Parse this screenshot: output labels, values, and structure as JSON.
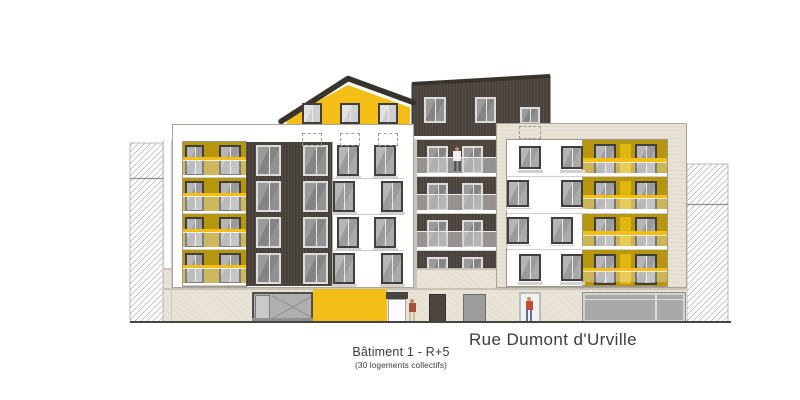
{
  "annotations": {
    "street_label": "Rue Dumont d'Urville",
    "building_label": "Bâtiment 1 - R+5",
    "building_sublabel": "(30 logements collectifs)"
  },
  "palette": {
    "accent_yellow": "#F3BE16",
    "mustard_yellow": "#B6960E",
    "dark_cladding": "#4A433D",
    "stone_beige": "#E7E2D3",
    "ground_beige": "#E9E4D6",
    "window_glass_gray": "#A7A7A7",
    "annotation_text": "#3C3C3C"
  }
}
